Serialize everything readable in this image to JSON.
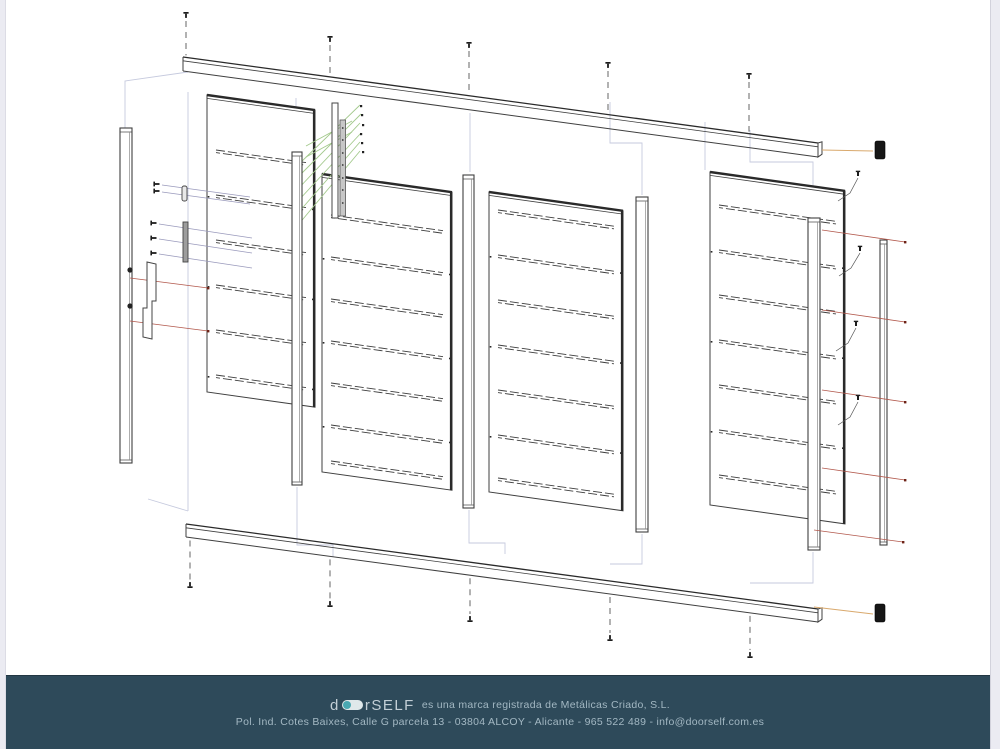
{
  "page": {
    "background": "#ffffff",
    "edge_strip_color": "#ebebf2"
  },
  "footer": {
    "background": "#2e4a5a",
    "accent_teal": "#49a8b2",
    "text_color": "#a3b8c3",
    "logo_prefix": "d",
    "logo_suffix": "rSELF",
    "trademark_text": "es una marca registrada de Metálicas Criado, S.L.",
    "address_text": "Pol. Ind. Cotes Baixes, Calle G parcela 13 - 03804 ALCOY - Alicante - 965 522 489 - info@doorself.com.es"
  },
  "diagram": {
    "slope": 0.14,
    "stroke": "#3f3f3f",
    "dark_stroke": "#2a2a2a",
    "ghost_color": "#c6cade",
    "green": "#a3c98c",
    "red": "#b2584c",
    "red_dot": "#6e2418",
    "violet": "#9a9abc",
    "orange": "#d9a96d",
    "cap_fill": "#161616",
    "panels": [
      {
        "x": 207,
        "w": 108,
        "top": 95,
        "h": 297,
        "slats": [
          150,
          195,
          240,
          285,
          330,
          375
        ]
      },
      {
        "x": 322,
        "w": 130,
        "top": 174,
        "h": 298,
        "slats": [
          215,
          257,
          299,
          341,
          383,
          425,
          461
        ]
      },
      {
        "x": 489,
        "w": 134,
        "top": 192,
        "h": 300,
        "slats": [
          210,
          255,
          300,
          345,
          390,
          435,
          478
        ]
      },
      {
        "x": 710,
        "w": 135,
        "top": 172,
        "h": 333,
        "slats": [
          205,
          250,
          295,
          340,
          385,
          430,
          475
        ]
      }
    ],
    "profiles": [
      {
        "x": 120,
        "w": 12,
        "y1": 128,
        "y2": 463
      },
      {
        "x": 292,
        "w": 10,
        "y1": 152,
        "y2": 485
      },
      {
        "x": 463,
        "w": 11,
        "y1": 175,
        "y2": 508
      },
      {
        "x": 636,
        "w": 12,
        "y1": 197,
        "y2": 532
      },
      {
        "x": 808,
        "w": 12,
        "y1": 218,
        "y2": 550
      },
      {
        "x": 880,
        "w": 7,
        "y1": 240,
        "y2": 545
      }
    ],
    "rails": {
      "top": {
        "x1": 183,
        "y1": 57,
        "x2": 818,
        "y2": 143,
        "th": 14
      },
      "bottom": {
        "x1": 186,
        "y1": 524,
        "x2": 818,
        "y2": 609,
        "th": 13
      }
    },
    "top_screws": [
      [
        186,
        12
      ],
      [
        330,
        36
      ],
      [
        469,
        42
      ],
      [
        608,
        62
      ],
      [
        749,
        73
      ]
    ],
    "bottom_screws": [
      [
        190,
        588
      ],
      [
        330,
        607
      ],
      [
        470,
        622
      ],
      [
        610,
        641
      ],
      [
        750,
        658
      ]
    ],
    "end_caps": [
      [
        875,
        141
      ],
      [
        875,
        604
      ]
    ],
    "orange_leaders": [
      [
        822,
        150,
        873,
        151
      ],
      [
        814,
        607,
        873,
        614
      ]
    ],
    "ghost_lines": [
      [
        [
          188,
          72
        ],
        [
          125,
          81
        ],
        [
          125,
          463
        ]
      ],
      [
        [
          188,
          92
        ],
        [
          188,
          511
        ]
      ],
      [
        [
          148,
          499
        ],
        [
          188,
          511
        ]
      ],
      [
        [
          470,
          113
        ],
        [
          470,
          172
        ]
      ],
      [
        [
          610,
          102
        ],
        [
          610,
          143
        ],
        [
          642,
          143
        ],
        [
          642,
          195
        ]
      ],
      [
        [
          750,
          130
        ],
        [
          750,
          162
        ],
        [
          813,
          162
        ],
        [
          813,
          216
        ]
      ],
      [
        [
          296,
          98
        ],
        [
          296,
          150
        ]
      ],
      [
        [
          705,
          122
        ],
        [
          705,
          170
        ]
      ],
      [
        [
          297,
          487
        ],
        [
          297,
          545
        ],
        [
          333,
          545
        ],
        [
          333,
          557
        ]
      ],
      [
        [
          469,
          510
        ],
        [
          469,
          543
        ],
        [
          505,
          543
        ],
        [
          505,
          554
        ]
      ],
      [
        [
          642,
          534
        ],
        [
          642,
          564
        ],
        [
          610,
          564
        ]
      ],
      [
        [
          813,
          552
        ],
        [
          813,
          583
        ],
        [
          750,
          583
        ]
      ]
    ],
    "red_leaders": [
      [
        822,
        230,
        905,
        242
      ],
      [
        822,
        310,
        905,
        322
      ],
      [
        822,
        390,
        905,
        402
      ],
      [
        822,
        468,
        905,
        480
      ],
      [
        814,
        530,
        903,
        542
      ],
      [
        130,
        278,
        208,
        288
      ],
      [
        130,
        321,
        208,
        331
      ]
    ],
    "violet_leaders": [
      [
        162,
        185,
        250,
        197
      ],
      [
        162,
        192,
        250,
        204
      ],
      [
        159,
        224,
        252,
        238
      ],
      [
        159,
        239,
        252,
        253
      ],
      [
        159,
        254,
        252,
        268
      ]
    ],
    "left_screws": [
      [
        155,
        184
      ],
      [
        155,
        191
      ],
      [
        152,
        223
      ],
      [
        152,
        238
      ],
      [
        152,
        253
      ]
    ],
    "bent_leaders": [
      [
        [
          858,
          178
        ],
        [
          850,
          193
        ],
        [
          838,
          201
        ]
      ],
      [
        [
          860,
          253
        ],
        [
          851,
          268
        ],
        [
          839,
          276
        ]
      ],
      [
        [
          856,
          328
        ],
        [
          848,
          343
        ],
        [
          836,
          351
        ]
      ],
      [
        [
          858,
          402
        ],
        [
          850,
          417
        ],
        [
          838,
          425
        ]
      ]
    ],
    "hinge": {
      "bar": [
        332,
        103,
        6,
        115
      ],
      "strip": [
        340,
        120,
        5.5,
        96
      ],
      "holes_y": [
        128,
        140,
        153,
        165,
        178,
        190,
        203
      ],
      "screw_dots": [
        [
          360,
          105
        ],
        [
          361,
          114
        ],
        [
          362,
          124
        ],
        [
          360,
          133
        ],
        [
          361,
          142
        ],
        [
          362,
          151
        ]
      ],
      "green_lines": [
        [
          298,
          225,
          360,
          151
        ],
        [
          298,
          213,
          360,
          142
        ],
        [
          298,
          201,
          361,
          133
        ],
        [
          298,
          189,
          360,
          123
        ],
        [
          298,
          177,
          361,
          114
        ],
        [
          298,
          165,
          360,
          105
        ],
        [
          306,
          157,
          352,
          132
        ],
        [
          306,
          146,
          352,
          121
        ]
      ]
    },
    "lock": {
      "bracket_path": "M147,262 L156,264 L156,301 L152,301 L152,339 L143,337 L143,308 L147,308 Z",
      "strike": [
        183,
        222,
        5,
        40
      ],
      "keeper": [
        182,
        186,
        5,
        15
      ],
      "post_holes": [
        [
          130,
          270
        ],
        [
          130,
          306
        ]
      ]
    }
  }
}
